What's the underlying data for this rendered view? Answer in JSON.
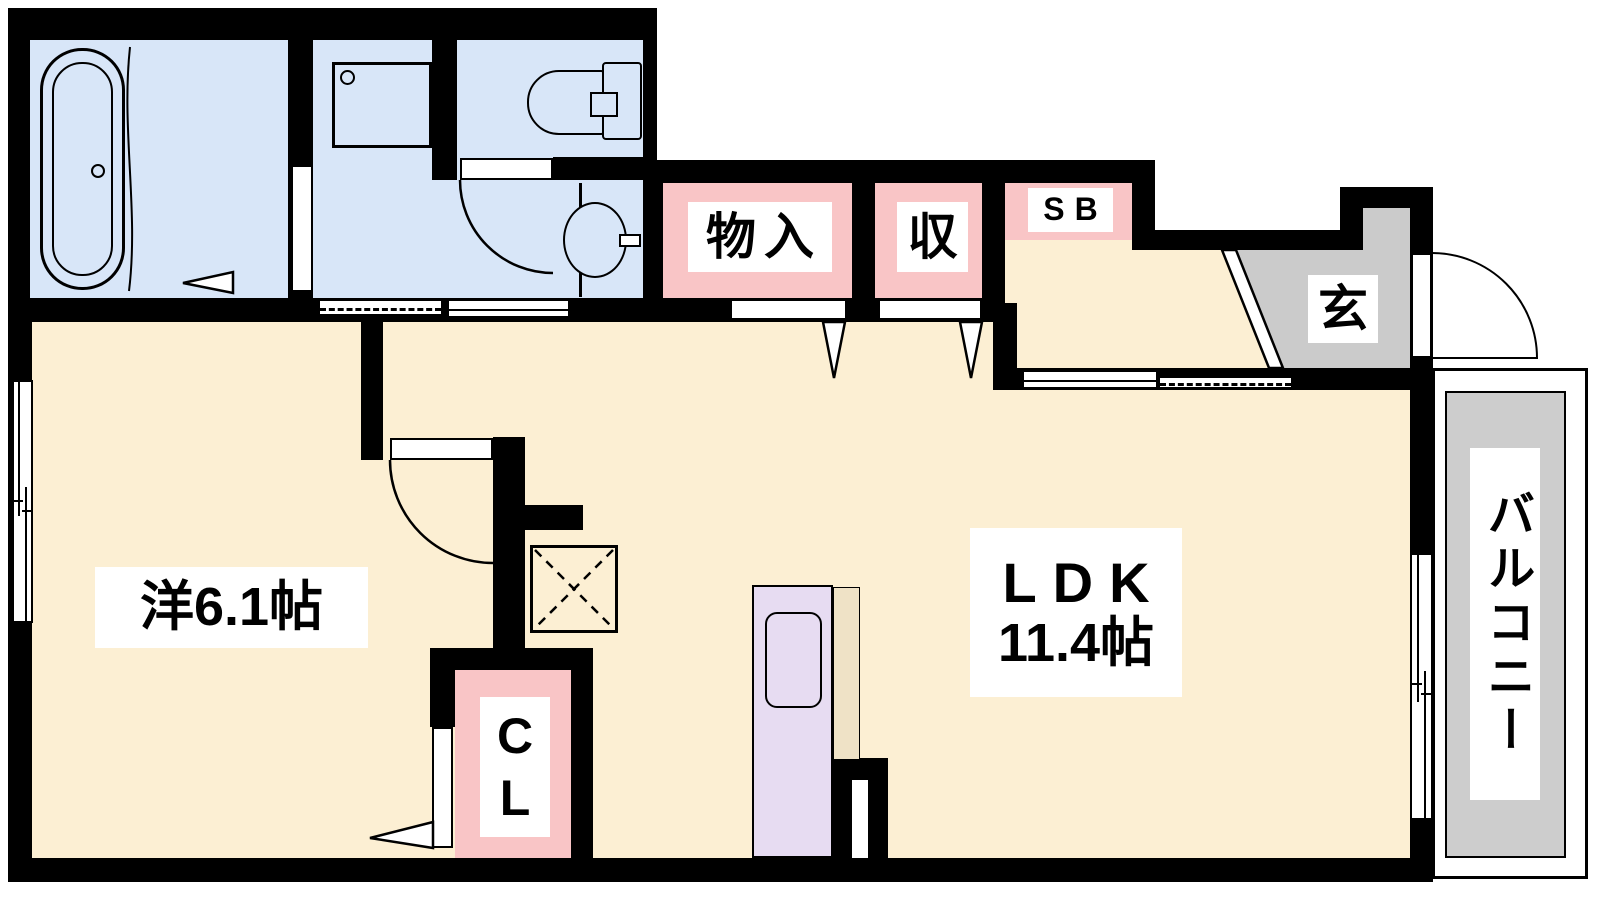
{
  "plan": {
    "type": "apartment-floorplan",
    "labels": {
      "western_room": "洋6.1帖",
      "ldk_line1": "LDK",
      "ldk_line2": "11.4帖",
      "storage1": "物入",
      "storage2": "収",
      "shoe_box": "SB",
      "entrance": "玄",
      "closet_top": "C",
      "closet_bottom": "L",
      "balcony": "バルコニー"
    },
    "colors": {
      "floor": "#FCEFD3",
      "wet": "#D8E6F8",
      "pink": "#F9C5C6",
      "gray": "#CBCBCB",
      "balcony": "#CDCDCD",
      "purple": "#E7DCF2",
      "beige": "#EFE2C6",
      "wall": "#000000"
    },
    "fixtures": [
      "bathtub",
      "washing-machine-pan",
      "toilet",
      "washbasin",
      "kitchen-counter",
      "kitchen-sink",
      "shoe-box",
      "pipe-space"
    ]
  }
}
